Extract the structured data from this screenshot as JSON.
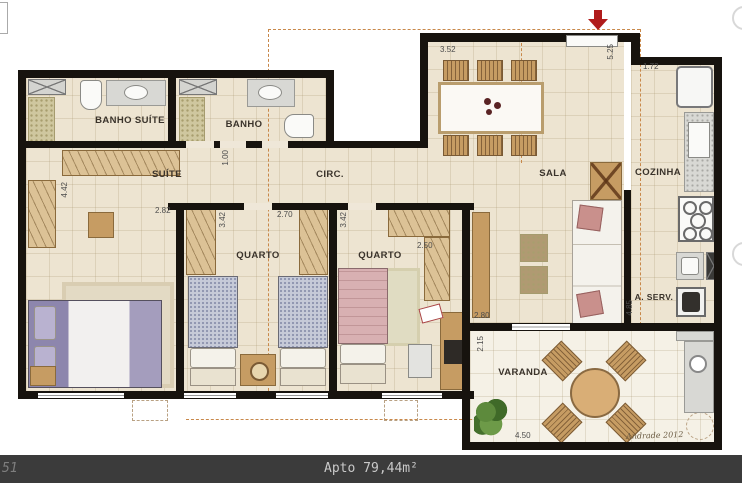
{
  "footer": {
    "page_number": "51",
    "caption": "Apto 79,44m²"
  },
  "signature": "Andrade 2012",
  "rooms": {
    "banho_suite": "BANHO SUÍTE",
    "banho": "BANHO",
    "suite": "SUÍTE",
    "circ": "CIRC.",
    "quarto1": "QUARTO",
    "quarto2": "QUARTO",
    "sala": "SALA",
    "cozinha": "COZINHA",
    "aserv": "A. SERV.",
    "varanda": "VARANDA"
  },
  "dims": {
    "dining_width": "3.52",
    "entry_height": "5.25",
    "kitchen_width": "1.72",
    "suite_height": "4.42",
    "suite_width": "2.82",
    "circ_height": "1.00",
    "quarto1_height": "3.42",
    "quarto1_width": "2.70",
    "quarto2_height": "3.42",
    "quarto2_width": "2.50",
    "sala_width": "2.80",
    "varanda_height": "2.15",
    "cozinha_height": "4.85",
    "varanda_width": "4.50"
  },
  "colors": {
    "wall": "#17130e",
    "floor": "#ede4d1",
    "varanda_floor": "#f5f1e6",
    "wood": "#c69c63",
    "projection_dash": "#c8884a",
    "entry_arrow": "#b01c1c",
    "footer_bg": "#3b3b3b",
    "footer_text": "#c9c9c9"
  }
}
